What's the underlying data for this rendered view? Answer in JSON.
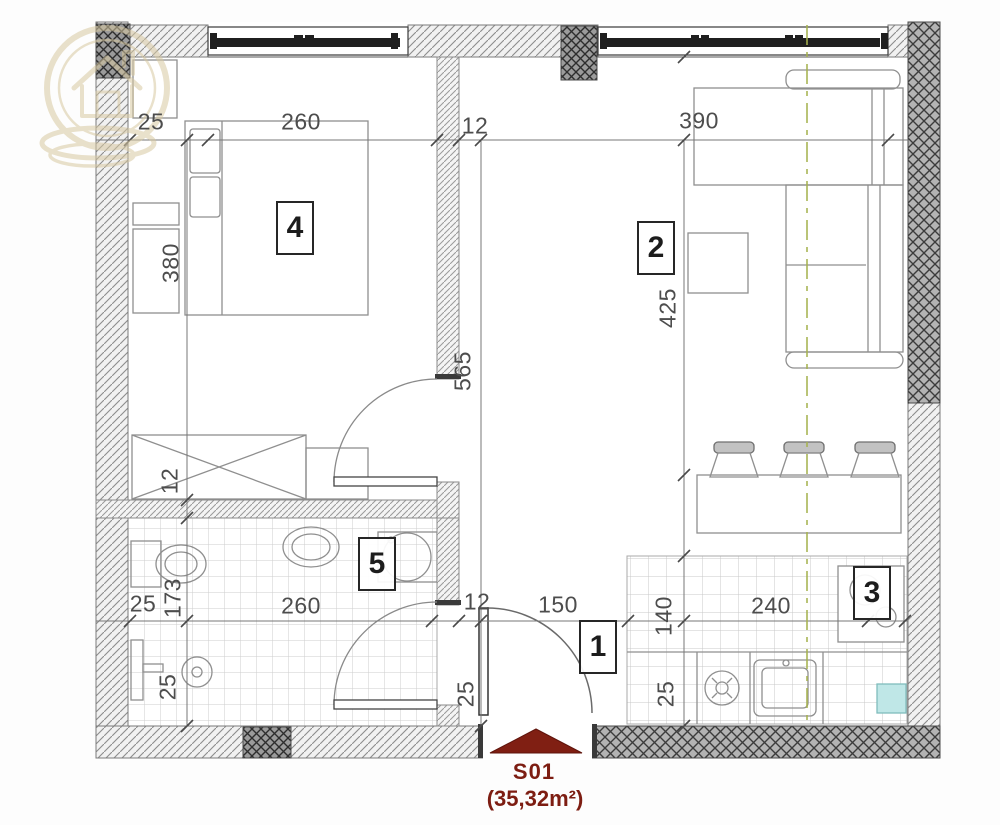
{
  "unit": {
    "code": "S01",
    "area": "(35,32m²)"
  },
  "rooms": [
    {
      "number": "1"
    },
    {
      "number": "2"
    },
    {
      "number": "3"
    },
    {
      "number": "4"
    },
    {
      "number": "5"
    }
  ],
  "dims": [
    {
      "text": "25"
    },
    {
      "text": "260"
    },
    {
      "text": "12"
    },
    {
      "text": "390"
    },
    {
      "text": "380"
    },
    {
      "text": "12"
    },
    {
      "text": "173"
    },
    {
      "text": "25"
    },
    {
      "text": "25"
    },
    {
      "text": "565"
    },
    {
      "text": "425"
    },
    {
      "text": "260"
    },
    {
      "text": "12"
    },
    {
      "text": "150"
    },
    {
      "text": "240"
    },
    {
      "text": "140"
    },
    {
      "text": "25"
    },
    {
      "text": "25"
    }
  ],
  "colors": {
    "entrance_red": "#801f13",
    "dimension_text": "#4d4d4d",
    "section_line_green": "#a6b14d",
    "logo_tan": "#d8c9a2",
    "dark_wall": "#b2b2b2",
    "cyan_accent": "#bfe7e7"
  },
  "icons": [
    {
      "name": "house-logo-watermark"
    },
    {
      "name": "entrance-direction-arrow"
    }
  ]
}
